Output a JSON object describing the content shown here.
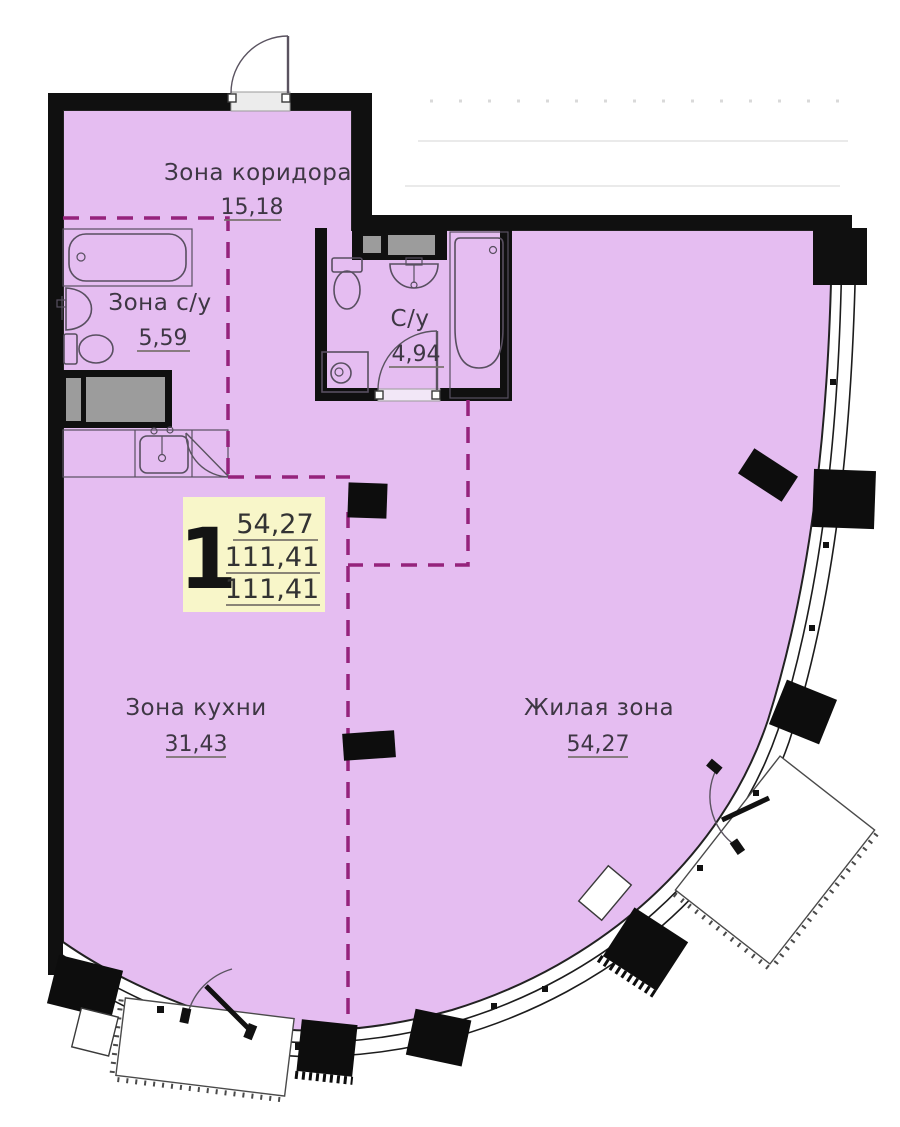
{
  "zones": {
    "corridor": {
      "name": "Зона коридора",
      "area": "15,18"
    },
    "sanitary_zone": {
      "name": "Зона с/у",
      "area": "5,59"
    },
    "bathroom": {
      "name": "С/у",
      "area": "4,94"
    },
    "kitchen": {
      "name": "Зона кухни",
      "area": "31,43"
    },
    "living": {
      "name": "Жилая зона",
      "area": "54,27"
    }
  },
  "info_badge": {
    "room_count": "1",
    "living_area": "54,27",
    "area": "111,41",
    "total_area": "111,41"
  },
  "colors": {
    "floor": "#e5bdf1",
    "walls": "#101010",
    "zone_dash": "#95237c",
    "badge_bg": "#f8f6c9",
    "vent_gray": "#9c9c9c",
    "text": "#3e3744"
  }
}
